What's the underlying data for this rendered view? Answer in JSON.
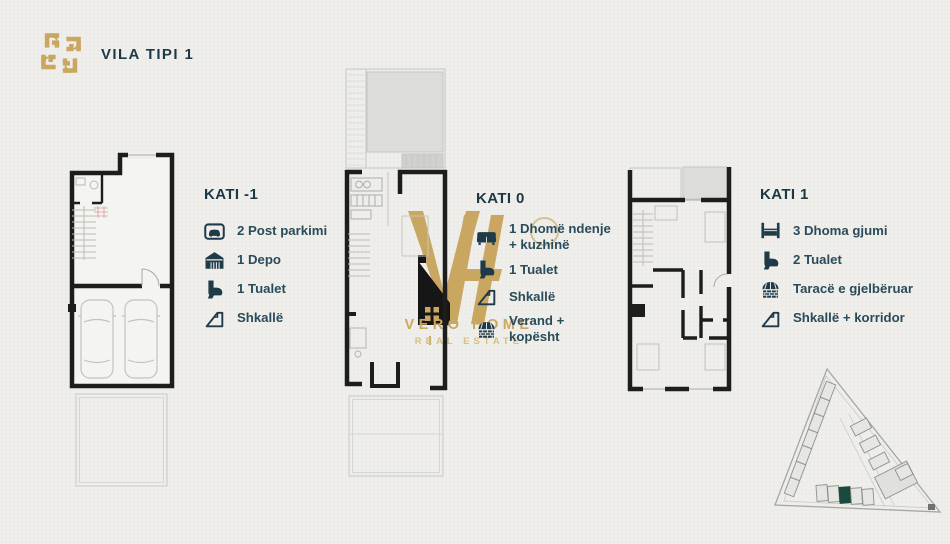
{
  "header": {
    "title": "VILA TIPI 1",
    "logo": "vero-home-emblem-icon"
  },
  "floors": [
    {
      "heading": "KATI -1",
      "items": [
        {
          "icon": "parking-icon",
          "label": "2 Post parkimi"
        },
        {
          "icon": "warehouse-icon",
          "label": "1 Depo"
        },
        {
          "icon": "toilet-icon",
          "label": "1 Tualet"
        },
        {
          "icon": "stairs-icon",
          "label": "Shkallë"
        }
      ]
    },
    {
      "heading": "KATI 0",
      "items": [
        {
          "icon": "sofa-icon",
          "label": "1 Dhomë ndenje + kuzhinë"
        },
        {
          "icon": "toilet-icon",
          "label": "1 Tualet"
        },
        {
          "icon": "stairs-icon",
          "label": "Shkallë"
        },
        {
          "icon": "veranda-icon",
          "label": "Verand + kopësht"
        }
      ]
    },
    {
      "heading": "KATI 1",
      "items": [
        {
          "icon": "bed-icon",
          "label": "3 Dhoma gjumi"
        },
        {
          "icon": "toilet-icon",
          "label": "2 Tualet"
        },
        {
          "icon": "terrace-icon",
          "label": "Taracë e gjelbëruar"
        },
        {
          "icon": "stairs-icon",
          "label": "Shkallë + korridor"
        }
      ]
    }
  ],
  "watermark": {
    "monogram": "VH",
    "name": "VERO HOME",
    "tagline": "REAL ESTATE"
  },
  "site_plan": {
    "shape": "triangular master plan",
    "highlighted_unit_color": "#1a4a3e"
  },
  "colors": {
    "background": "#efeeeb",
    "heading_text": "#1b3845",
    "item_text": "#2a4b5a",
    "gold": "#c9a761",
    "walls": "#1d1d1b",
    "plan_gray_fill": "#dcdcd9"
  }
}
